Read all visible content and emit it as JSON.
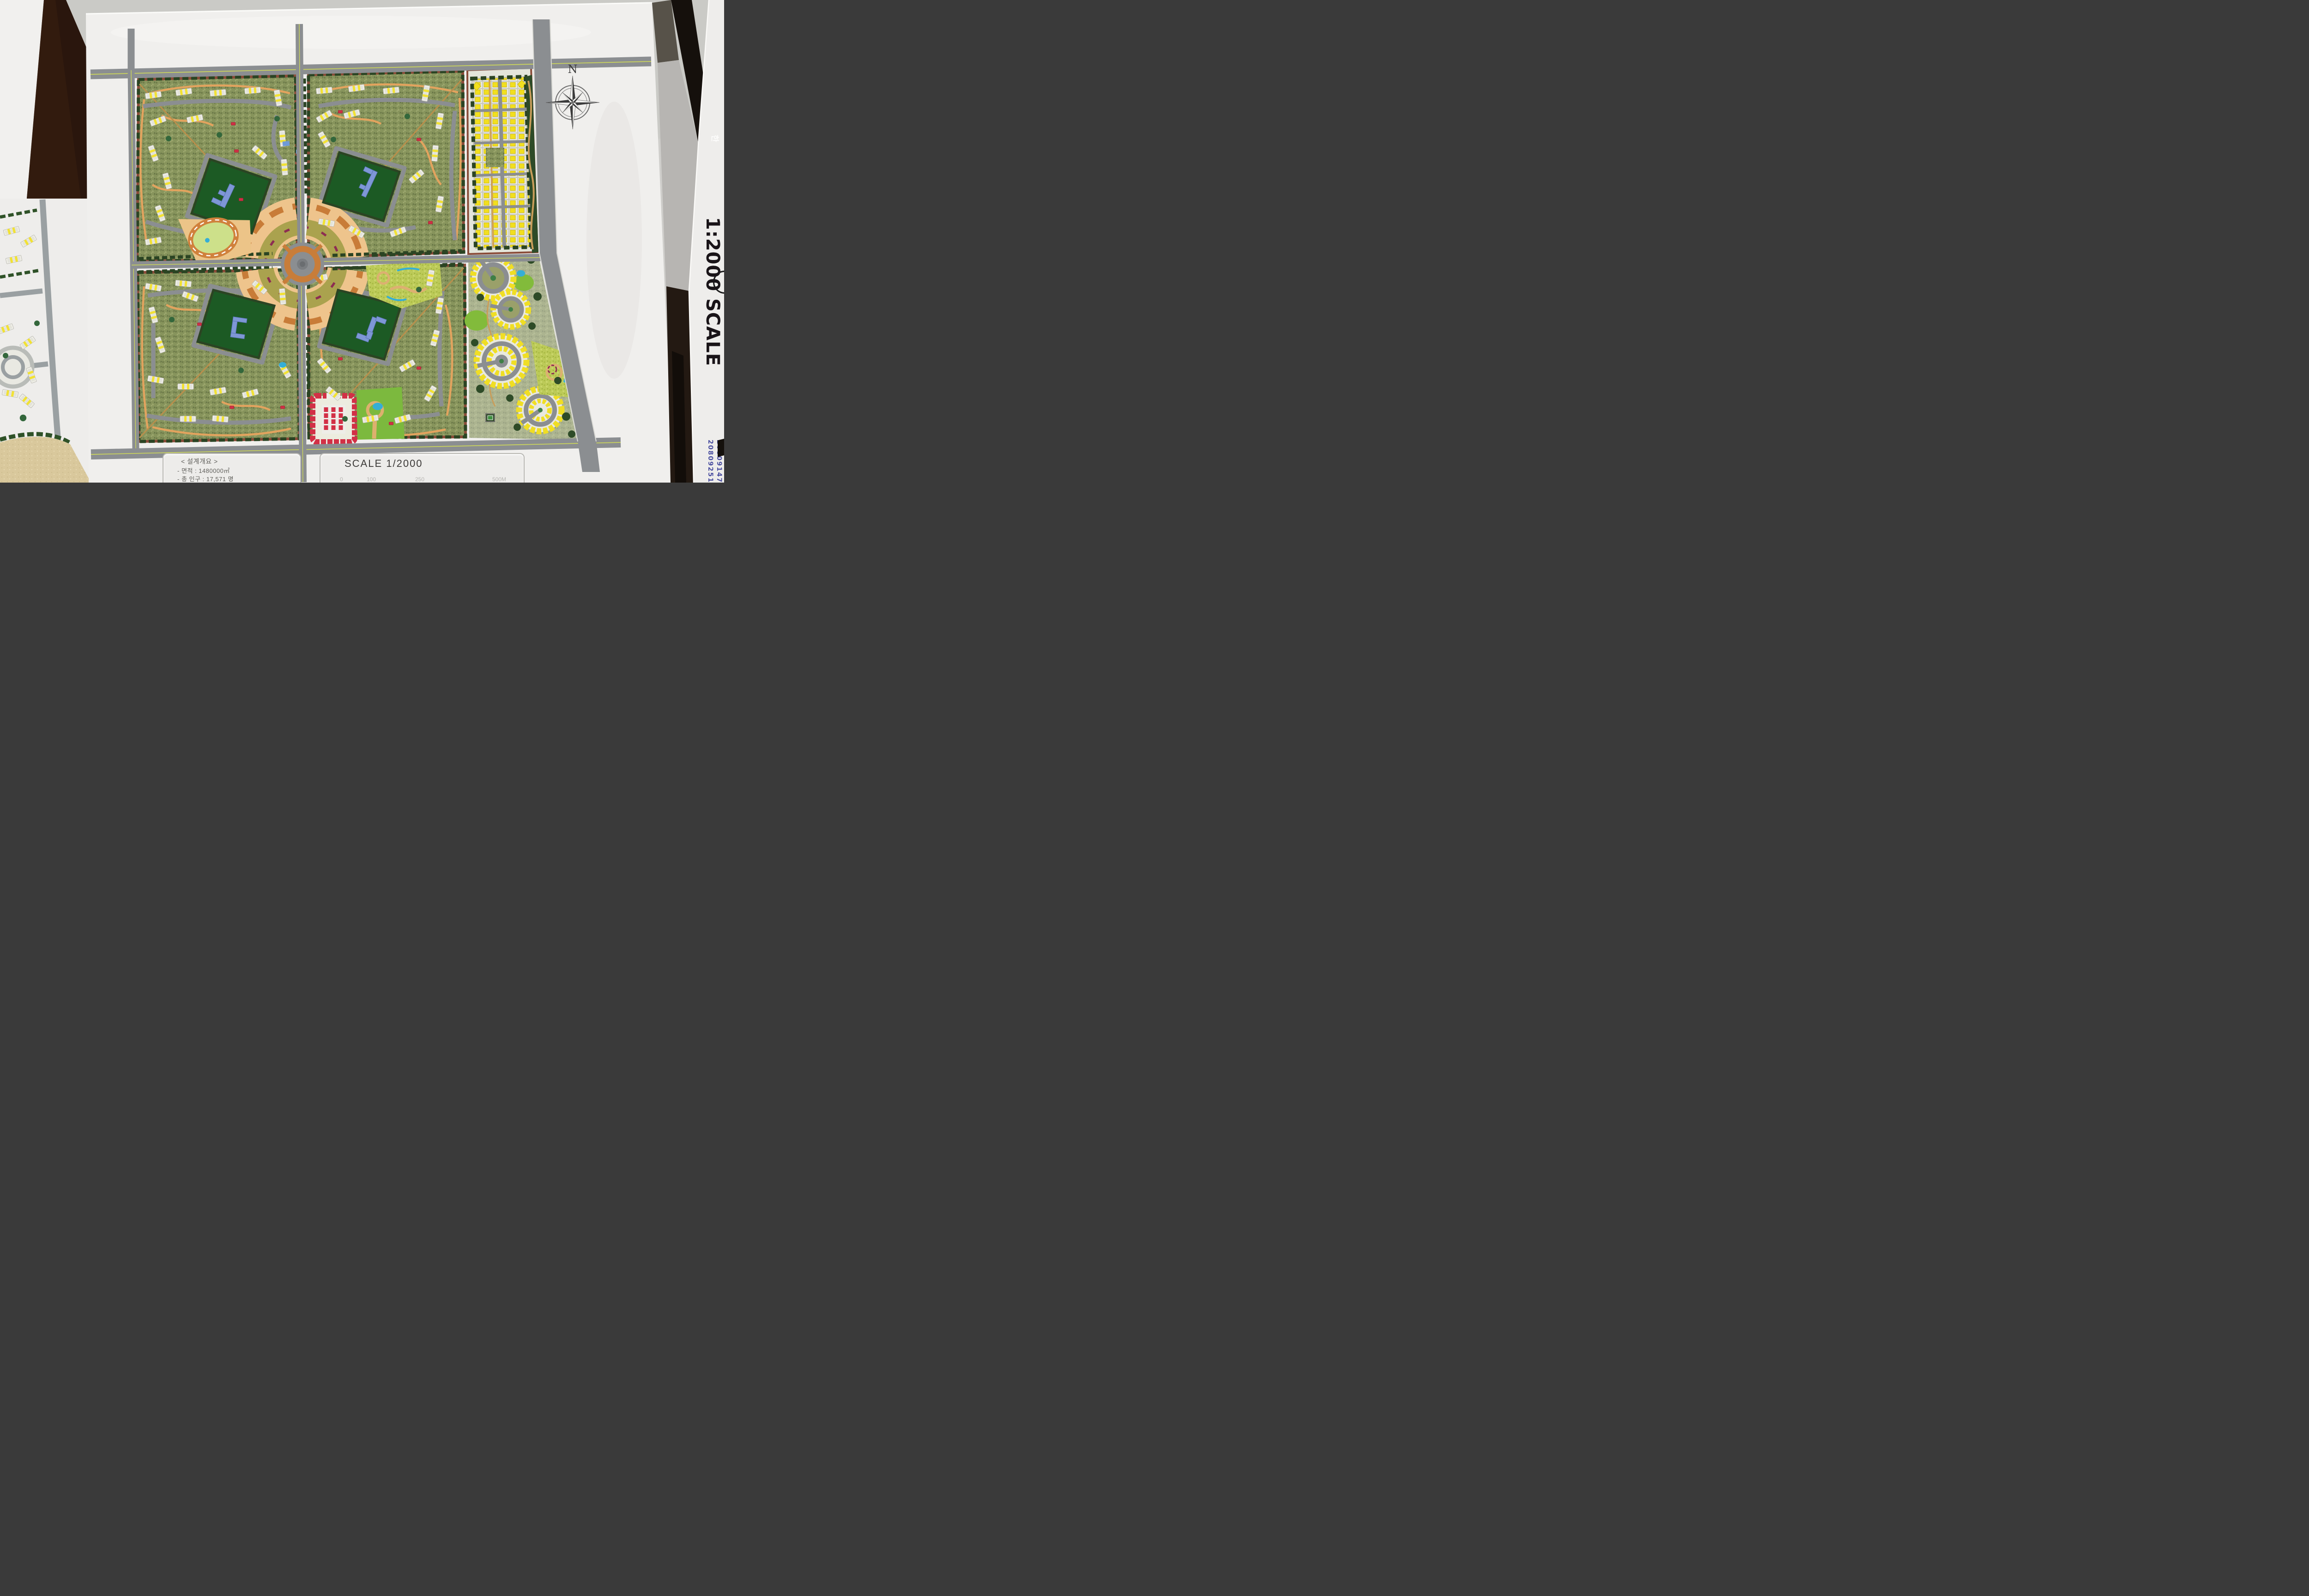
{
  "scene": {
    "description": "Photograph of a 1/2000 architectural scale model board of a residential masterplan, flanked by two other white model boards"
  },
  "main_board": {
    "legend_panel": {
      "title": "< 설계개요 >",
      "rows": [
        "- 면적 : 1480000㎡",
        "- 총 인구 : 17,571 명"
      ]
    },
    "scale_panel": {
      "label": "SCALE 1/2000",
      "ticks": [
        "0",
        "100",
        "250",
        "500M"
      ]
    },
    "compass": {
      "north": "N"
    }
  },
  "side_board": {
    "marker_note": "1:2000 SCALE",
    "pen_ids": [
      "20809147",
      "20809251"
    ],
    "ghost_mark": "한"
  },
  "palette": {
    "wall_gray": "#cfcecb",
    "board_white": "#f0efed",
    "road_gray": "#8b8e91",
    "centerline_yellow": "#cdd75a",
    "ground_green": "#87945c",
    "hedge_green": "#2b4423",
    "park_green": "#1c5a24",
    "lawn_green": "#7fb93c",
    "building_white": "#f0efe9",
    "stripe_yellow": "#f2e233",
    "house_yellow": "#f2df1f",
    "path_orange": "#e2a35e",
    "plaza_orange": "#eec48c",
    "ring_orange": "#c87d3a",
    "accent_red": "#d02f45",
    "water_blue": "#35aed6",
    "civic_blue": "#7e97d6",
    "sand_tan": "#d9c89c",
    "table_brown": "#2a160d",
    "marker_black": "#191418",
    "pen_blue": "#4b4fa0"
  }
}
